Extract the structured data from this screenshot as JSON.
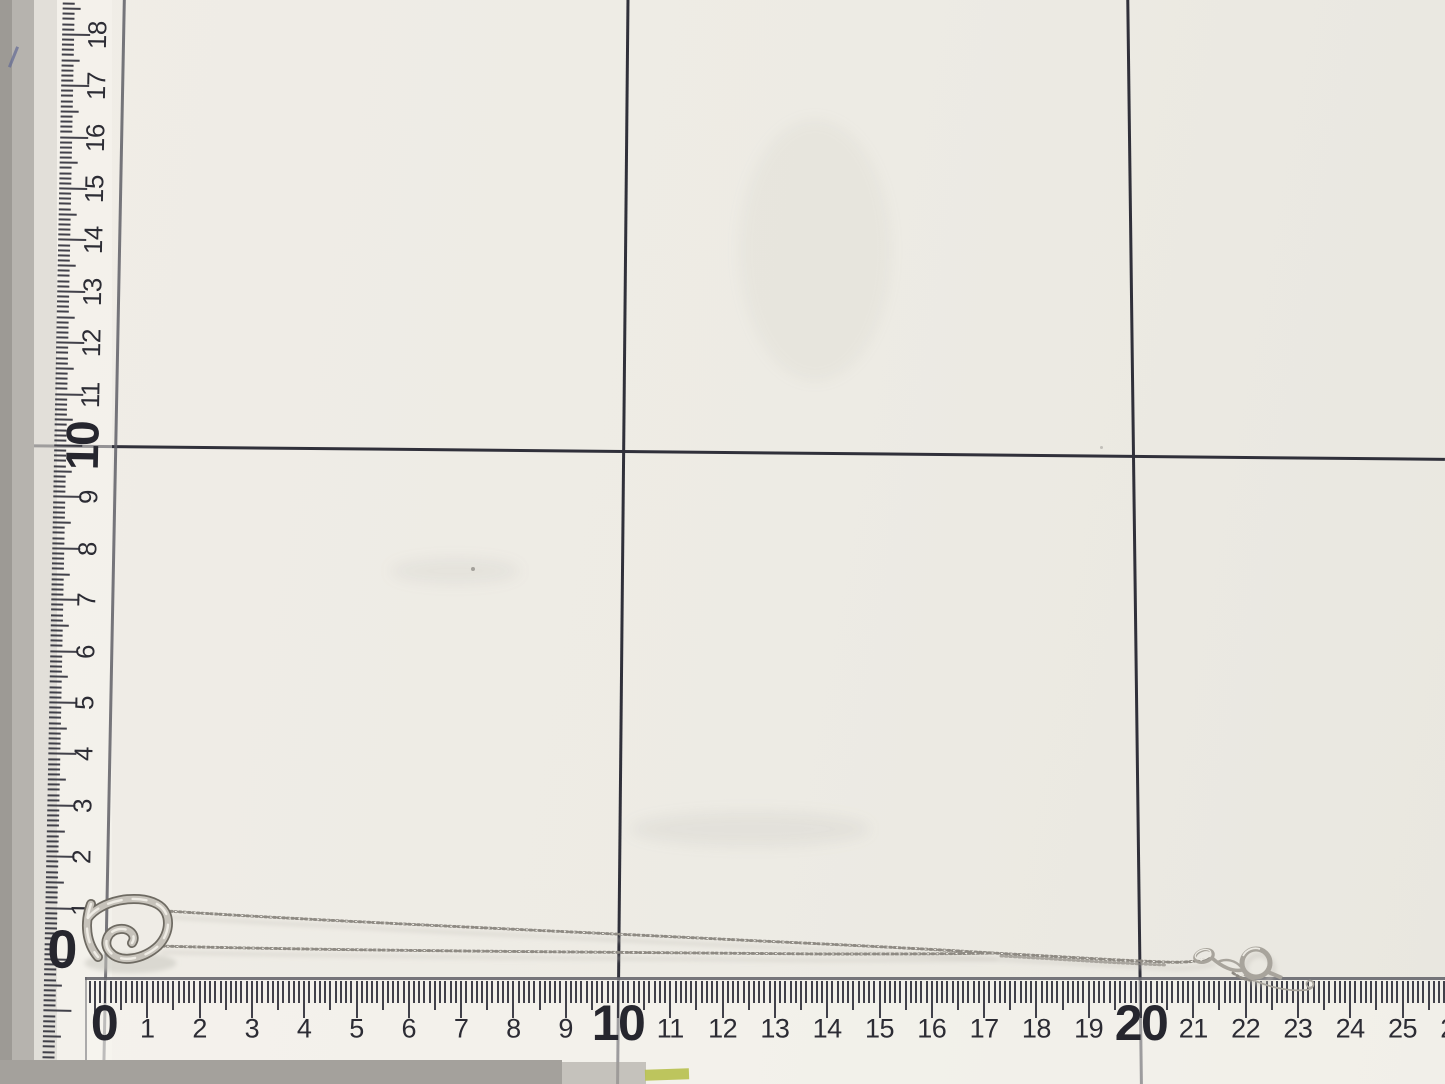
{
  "scene": {
    "subject": "silver open-heart pendant necklace",
    "surface": "white measuring grid board, 10 cm squares",
    "unit": "cm"
  },
  "colors": {
    "mat": "#edebe4",
    "grid_line": "#30303a",
    "tick": "#32323c",
    "label": "#2c2c34",
    "ruler_edge": "#5f5f66",
    "silver": "#c7c3bb",
    "silver_dark": "#6e6a62",
    "silver_highlight": "#f3f1ea"
  },
  "left_ruler": {
    "unit": "cm",
    "labels": [
      {
        "v": "0",
        "bold": true
      },
      {
        "v": "1",
        "bold": false
      },
      {
        "v": "2",
        "bold": false
      },
      {
        "v": "3",
        "bold": false
      },
      {
        "v": "4",
        "bold": false
      },
      {
        "v": "5",
        "bold": false
      },
      {
        "v": "6",
        "bold": false
      },
      {
        "v": "7",
        "bold": false
      },
      {
        "v": "8",
        "bold": false
      },
      {
        "v": "9",
        "bold": false
      },
      {
        "v": "10",
        "bold": true
      },
      {
        "v": "11",
        "bold": false
      },
      {
        "v": "12",
        "bold": false
      },
      {
        "v": "13",
        "bold": false
      },
      {
        "v": "14",
        "bold": false
      },
      {
        "v": "15",
        "bold": false
      },
      {
        "v": "16",
        "bold": false
      },
      {
        "v": "17",
        "bold": false
      },
      {
        "v": "18",
        "bold": false
      }
    ]
  },
  "bottom_ruler": {
    "unit": "cm",
    "labels": [
      {
        "v": "0",
        "bold": true
      },
      {
        "v": "1",
        "bold": false
      },
      {
        "v": "2",
        "bold": false
      },
      {
        "v": "3",
        "bold": false
      },
      {
        "v": "4",
        "bold": false
      },
      {
        "v": "5",
        "bold": false
      },
      {
        "v": "6",
        "bold": false
      },
      {
        "v": "7",
        "bold": false
      },
      {
        "v": "8",
        "bold": false
      },
      {
        "v": "9",
        "bold": false
      },
      {
        "v": "10",
        "bold": true
      },
      {
        "v": "11",
        "bold": false
      },
      {
        "v": "12",
        "bold": false
      },
      {
        "v": "13",
        "bold": false
      },
      {
        "v": "14",
        "bold": false
      },
      {
        "v": "15",
        "bold": false
      },
      {
        "v": "16",
        "bold": false
      },
      {
        "v": "17",
        "bold": false
      },
      {
        "v": "18",
        "bold": false
      },
      {
        "v": "19",
        "bold": false
      },
      {
        "v": "20",
        "bold": true
      },
      {
        "v": "21",
        "bold": false
      },
      {
        "v": "22",
        "bold": false
      },
      {
        "v": "23",
        "bold": false
      },
      {
        "v": "24",
        "bold": false
      },
      {
        "v": "25",
        "bold": false
      },
      {
        "v": "26",
        "bold": false
      }
    ]
  },
  "necklace": {
    "pendant": "open-heart-pendant",
    "chain": "fine-cable-chain",
    "clasp": "spring-ring-clasp"
  }
}
